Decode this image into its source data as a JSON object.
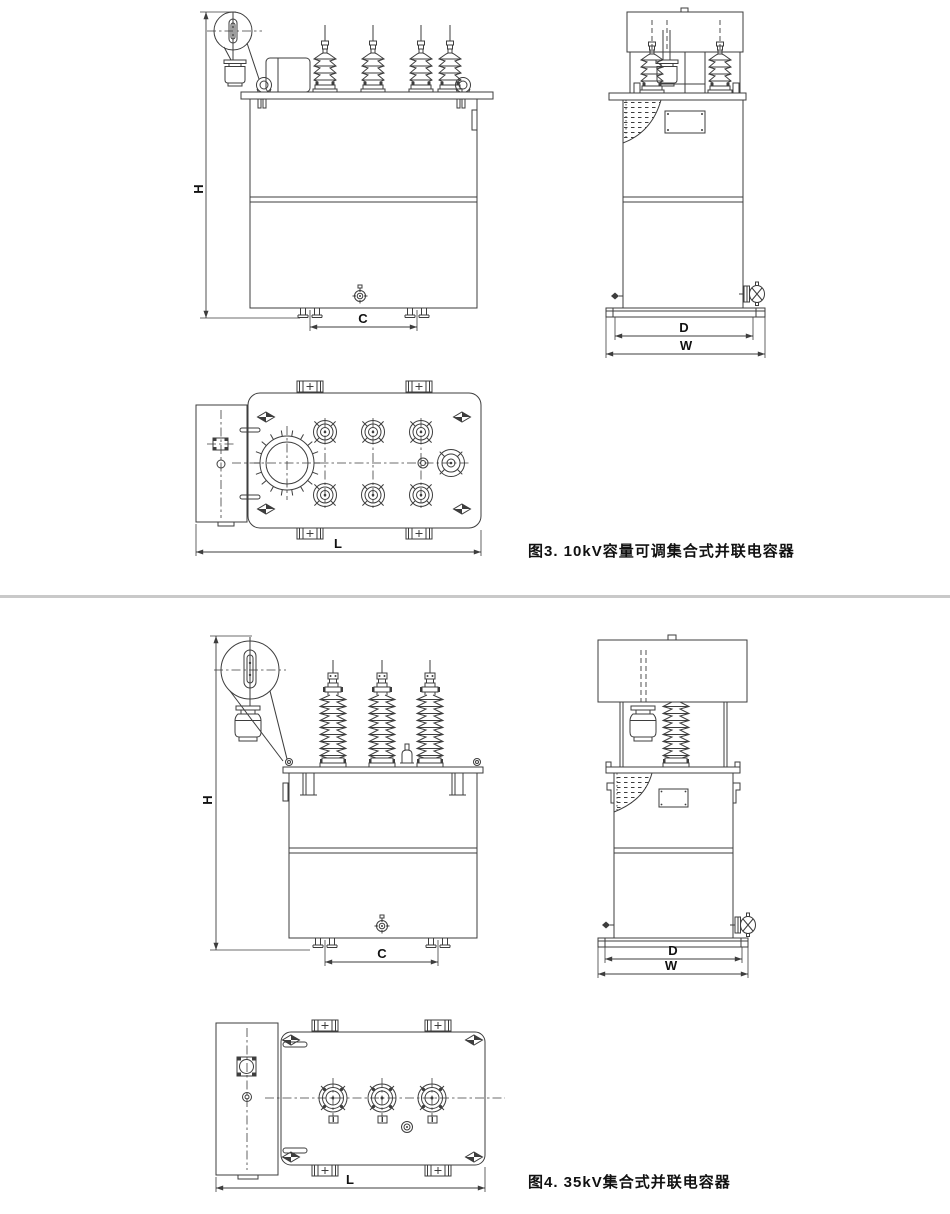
{
  "colors": {
    "line": "#3d3d3d",
    "divider": "#c9c9c9",
    "text": "#111111",
    "background": "#ffffff"
  },
  "figure3": {
    "caption": "图3.  10kV容量可调集合式并联电容器",
    "dims": {
      "H": "H",
      "C": "C",
      "D": "D",
      "W": "W",
      "L": "L"
    }
  },
  "figure4": {
    "caption": "图4.  35kV集合式并联电容器",
    "dims": {
      "H": "H",
      "C": "C",
      "D": "D",
      "W": "W",
      "L": "L"
    }
  }
}
